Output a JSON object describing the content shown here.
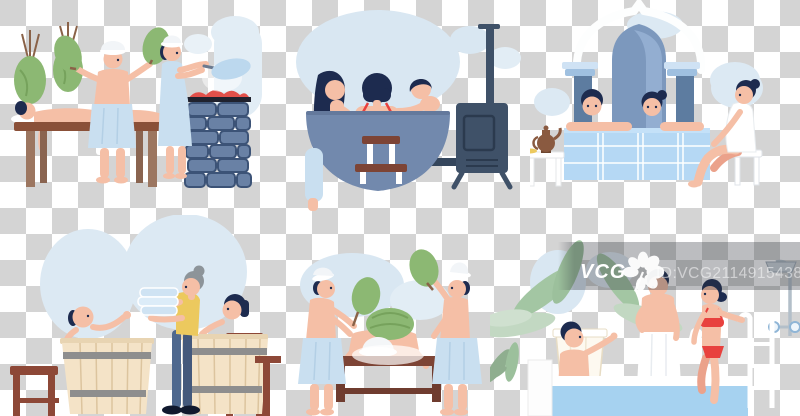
{
  "image": {
    "alt": "Flat vector illustration set: people steaming, bathing and relaxing in saunas, a hot tub, a hammam, barrel baths and a spa pool, on a transparent checkerboard background"
  },
  "watermark": {
    "brand": "VCG",
    "id_text": "ID:VCG211491543860"
  },
  "scenes": [
    {
      "name": "sauna-venik-massage-with-stone-stove"
    },
    {
      "name": "wooden-hot-tub-with-iron-stove"
    },
    {
      "name": "turkish-hammam-tiled-pool"
    },
    {
      "name": "barrel-baths-with-towel-attendant"
    },
    {
      "name": "venik-steam-treatment-on-table"
    },
    {
      "name": "spa-pool-with-palms-ladder-and-shower"
    }
  ],
  "colors": {
    "checker_gray": "#d4d4d4",
    "checker_white": "#ffffff",
    "steam_blue": "#d9e7f2",
    "skin": "#f5bfa6",
    "hair_dark": "#1d2b4f",
    "towel_blue": "#c9dff0",
    "wood_brown": "#7d4435",
    "barrel_wood": "#f4e3c7",
    "stone_blue": "#6981a5",
    "coal_red": "#e2504a",
    "tub_blue": "#7289ad",
    "iron_stove_blue": "#3f5168",
    "column_blue": "#5d7ca0",
    "pool_tile": "#b5d8f4",
    "water_blue": "#a6d2f0",
    "palm_green": "#a3c6a3",
    "venik_green": "#8cb873",
    "swimsuit_red": "#e8413e",
    "attendant_yellow": "#ecc95e",
    "jeans_blue": "#4e688e",
    "watermark_band": "rgba(45,49,58,0.32)",
    "watermark_text": "#ffffff"
  }
}
